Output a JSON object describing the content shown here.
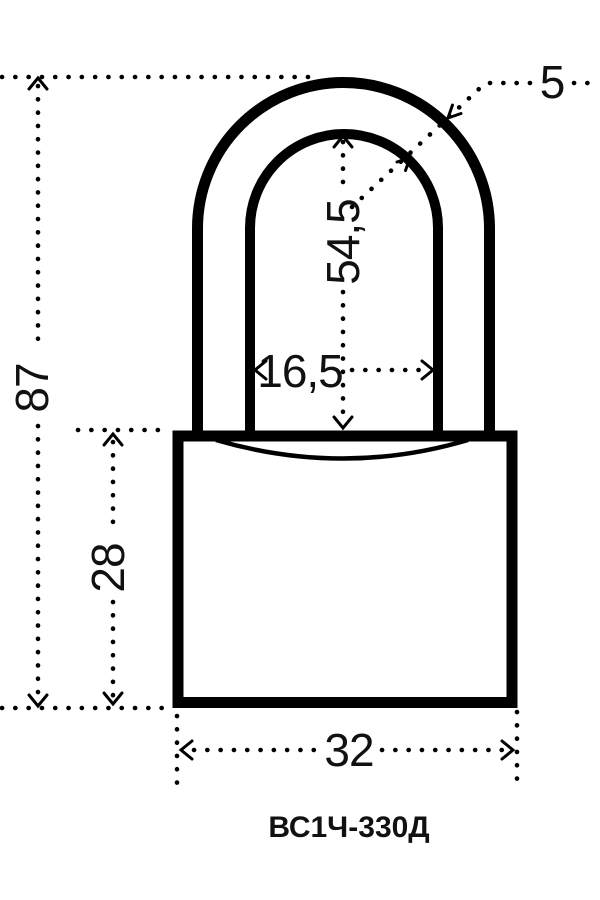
{
  "diagram": {
    "model_label": "ВС1Ч-330Д",
    "dimensions": {
      "overall_height": "87",
      "body_height": "28",
      "shackle_inner_height": "54,5",
      "shackle_inner_width": "16,5",
      "body_width": "32",
      "shackle_diameter": "5"
    },
    "colors": {
      "line": "#000000",
      "background": "#ffffff"
    }
  }
}
